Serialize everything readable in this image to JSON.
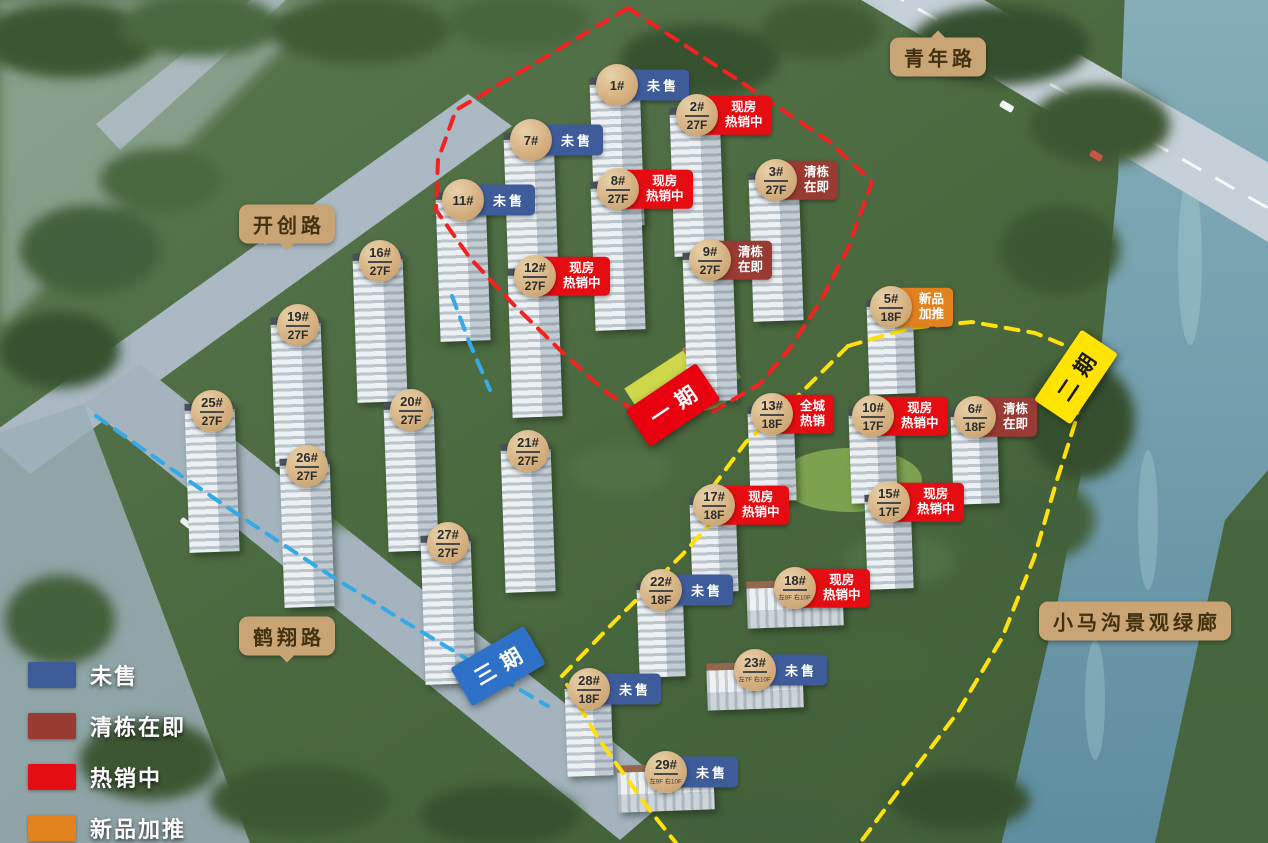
{
  "colors": {
    "unsold": "#3e5c9a",
    "clearing": "#993a33",
    "hot": "#e60d12",
    "new": "#e2821f"
  },
  "legend": {
    "items": [
      {
        "label": "未售",
        "key": "unsold"
      },
      {
        "label": "清栋在即",
        "key": "clearing"
      },
      {
        "label": "热销中",
        "key": "hot"
      },
      {
        "label": "新品加推",
        "key": "new"
      }
    ]
  },
  "roads": [
    {
      "name": "青年路",
      "x": 938,
      "y": 57,
      "pointer": "top"
    },
    {
      "name": "开创路",
      "x": 287,
      "y": 224,
      "pointer": "bottom"
    },
    {
      "name": "鹤翔路",
      "x": 287,
      "y": 636,
      "pointer": "bottom"
    },
    {
      "name": "小马沟景观绿廊",
      "x": 1135,
      "y": 621,
      "pointer": "none"
    }
  ],
  "phases": [
    {
      "name": "一期",
      "x": 673,
      "y": 405,
      "rotate": -34,
      "bg": "#e8000f",
      "fg": "#ffffff"
    },
    {
      "name": "二期",
      "x": 1076,
      "y": 377,
      "rotate": -56,
      "bg": "#ffe400",
      "fg": "#1a1a1a"
    },
    {
      "name": "三期",
      "x": 498,
      "y": 666,
      "rotate": -30,
      "bg": "#2e71c8",
      "fg": "#ffffff"
    }
  ],
  "buildings": [
    {
      "id": "1#",
      "floor": "",
      "note": "",
      "status": "未售",
      "key": "unsold",
      "x": 617,
      "y": 85
    },
    {
      "id": "7#",
      "floor": "",
      "note": "",
      "status": "未售",
      "key": "unsold",
      "x": 531,
      "y": 140
    },
    {
      "id": "2#",
      "floor": "27F",
      "note": "",
      "status": "现房/热销中",
      "key": "hot",
      "x": 697,
      "y": 115
    },
    {
      "id": "8#",
      "floor": "27F",
      "note": "",
      "status": "现房/热销中",
      "key": "hot",
      "x": 618,
      "y": 189
    },
    {
      "id": "3#",
      "floor": "27F",
      "note": "",
      "status": "清栋/在即",
      "key": "clearing",
      "x": 776,
      "y": 180
    },
    {
      "id": "11#",
      "floor": "",
      "note": "",
      "status": "未售",
      "key": "unsold",
      "x": 463,
      "y": 200
    },
    {
      "id": "12#",
      "floor": "27F",
      "note": "",
      "status": "现房/热销中",
      "key": "hot",
      "x": 535,
      "y": 276
    },
    {
      "id": "9#",
      "floor": "27F",
      "note": "",
      "status": "清栋/在即",
      "key": "clearing",
      "x": 710,
      "y": 260
    },
    {
      "id": "16#",
      "floor": "27F",
      "note": "",
      "status": "",
      "key": "",
      "x": 380,
      "y": 261
    },
    {
      "id": "5#",
      "floor": "18F",
      "note": "",
      "status": "新品/加推",
      "key": "new",
      "x": 891,
      "y": 307
    },
    {
      "id": "19#",
      "floor": "27F",
      "note": "",
      "status": "",
      "key": "",
      "x": 298,
      "y": 325
    },
    {
      "id": "25#",
      "floor": "27F",
      "note": "",
      "status": "",
      "key": "",
      "x": 212,
      "y": 411
    },
    {
      "id": "13#",
      "floor": "18F",
      "note": "",
      "status": "全城/热销",
      "key": "hot",
      "x": 772,
      "y": 414
    },
    {
      "id": "10#",
      "floor": "17F",
      "note": "",
      "status": "现房/热销中",
      "key": "hot",
      "x": 873,
      "y": 416
    },
    {
      "id": "6#",
      "floor": "18F",
      "note": "",
      "status": "清栋/在即",
      "key": "clearing",
      "x": 975,
      "y": 417
    },
    {
      "id": "20#",
      "floor": "27F",
      "note": "",
      "status": "",
      "key": "",
      "x": 411,
      "y": 410
    },
    {
      "id": "26#",
      "floor": "27F",
      "note": "",
      "status": "",
      "key": "",
      "x": 307,
      "y": 466
    },
    {
      "id": "21#",
      "floor": "27F",
      "note": "",
      "status": "",
      "key": "",
      "x": 528,
      "y": 451
    },
    {
      "id": "17#",
      "floor": "18F",
      "note": "",
      "status": "现房/热销中",
      "key": "hot",
      "x": 714,
      "y": 505
    },
    {
      "id": "15#",
      "floor": "17F",
      "note": "",
      "status": "现房/热销中",
      "key": "hot",
      "x": 889,
      "y": 502
    },
    {
      "id": "27#",
      "floor": "27F",
      "note": "",
      "status": "",
      "key": "",
      "x": 448,
      "y": 543
    },
    {
      "id": "22#",
      "floor": "18F",
      "note": "",
      "status": "未售",
      "key": "unsold",
      "x": 661,
      "y": 590
    },
    {
      "id": "18#",
      "floor": "",
      "note": "左8F 右10F",
      "status": "现房/热销中",
      "key": "hot",
      "x": 795,
      "y": 588
    },
    {
      "id": "28#",
      "floor": "18F",
      "note": "",
      "status": "未售",
      "key": "unsold",
      "x": 589,
      "y": 689
    },
    {
      "id": "23#",
      "floor": "",
      "note": "左7F 右10F",
      "status": "未售",
      "key": "unsold",
      "x": 755,
      "y": 670
    },
    {
      "id": "29#",
      "floor": "",
      "note": "左9F 右10F",
      "status": "未售",
      "key": "unsold",
      "x": 666,
      "y": 772
    }
  ]
}
